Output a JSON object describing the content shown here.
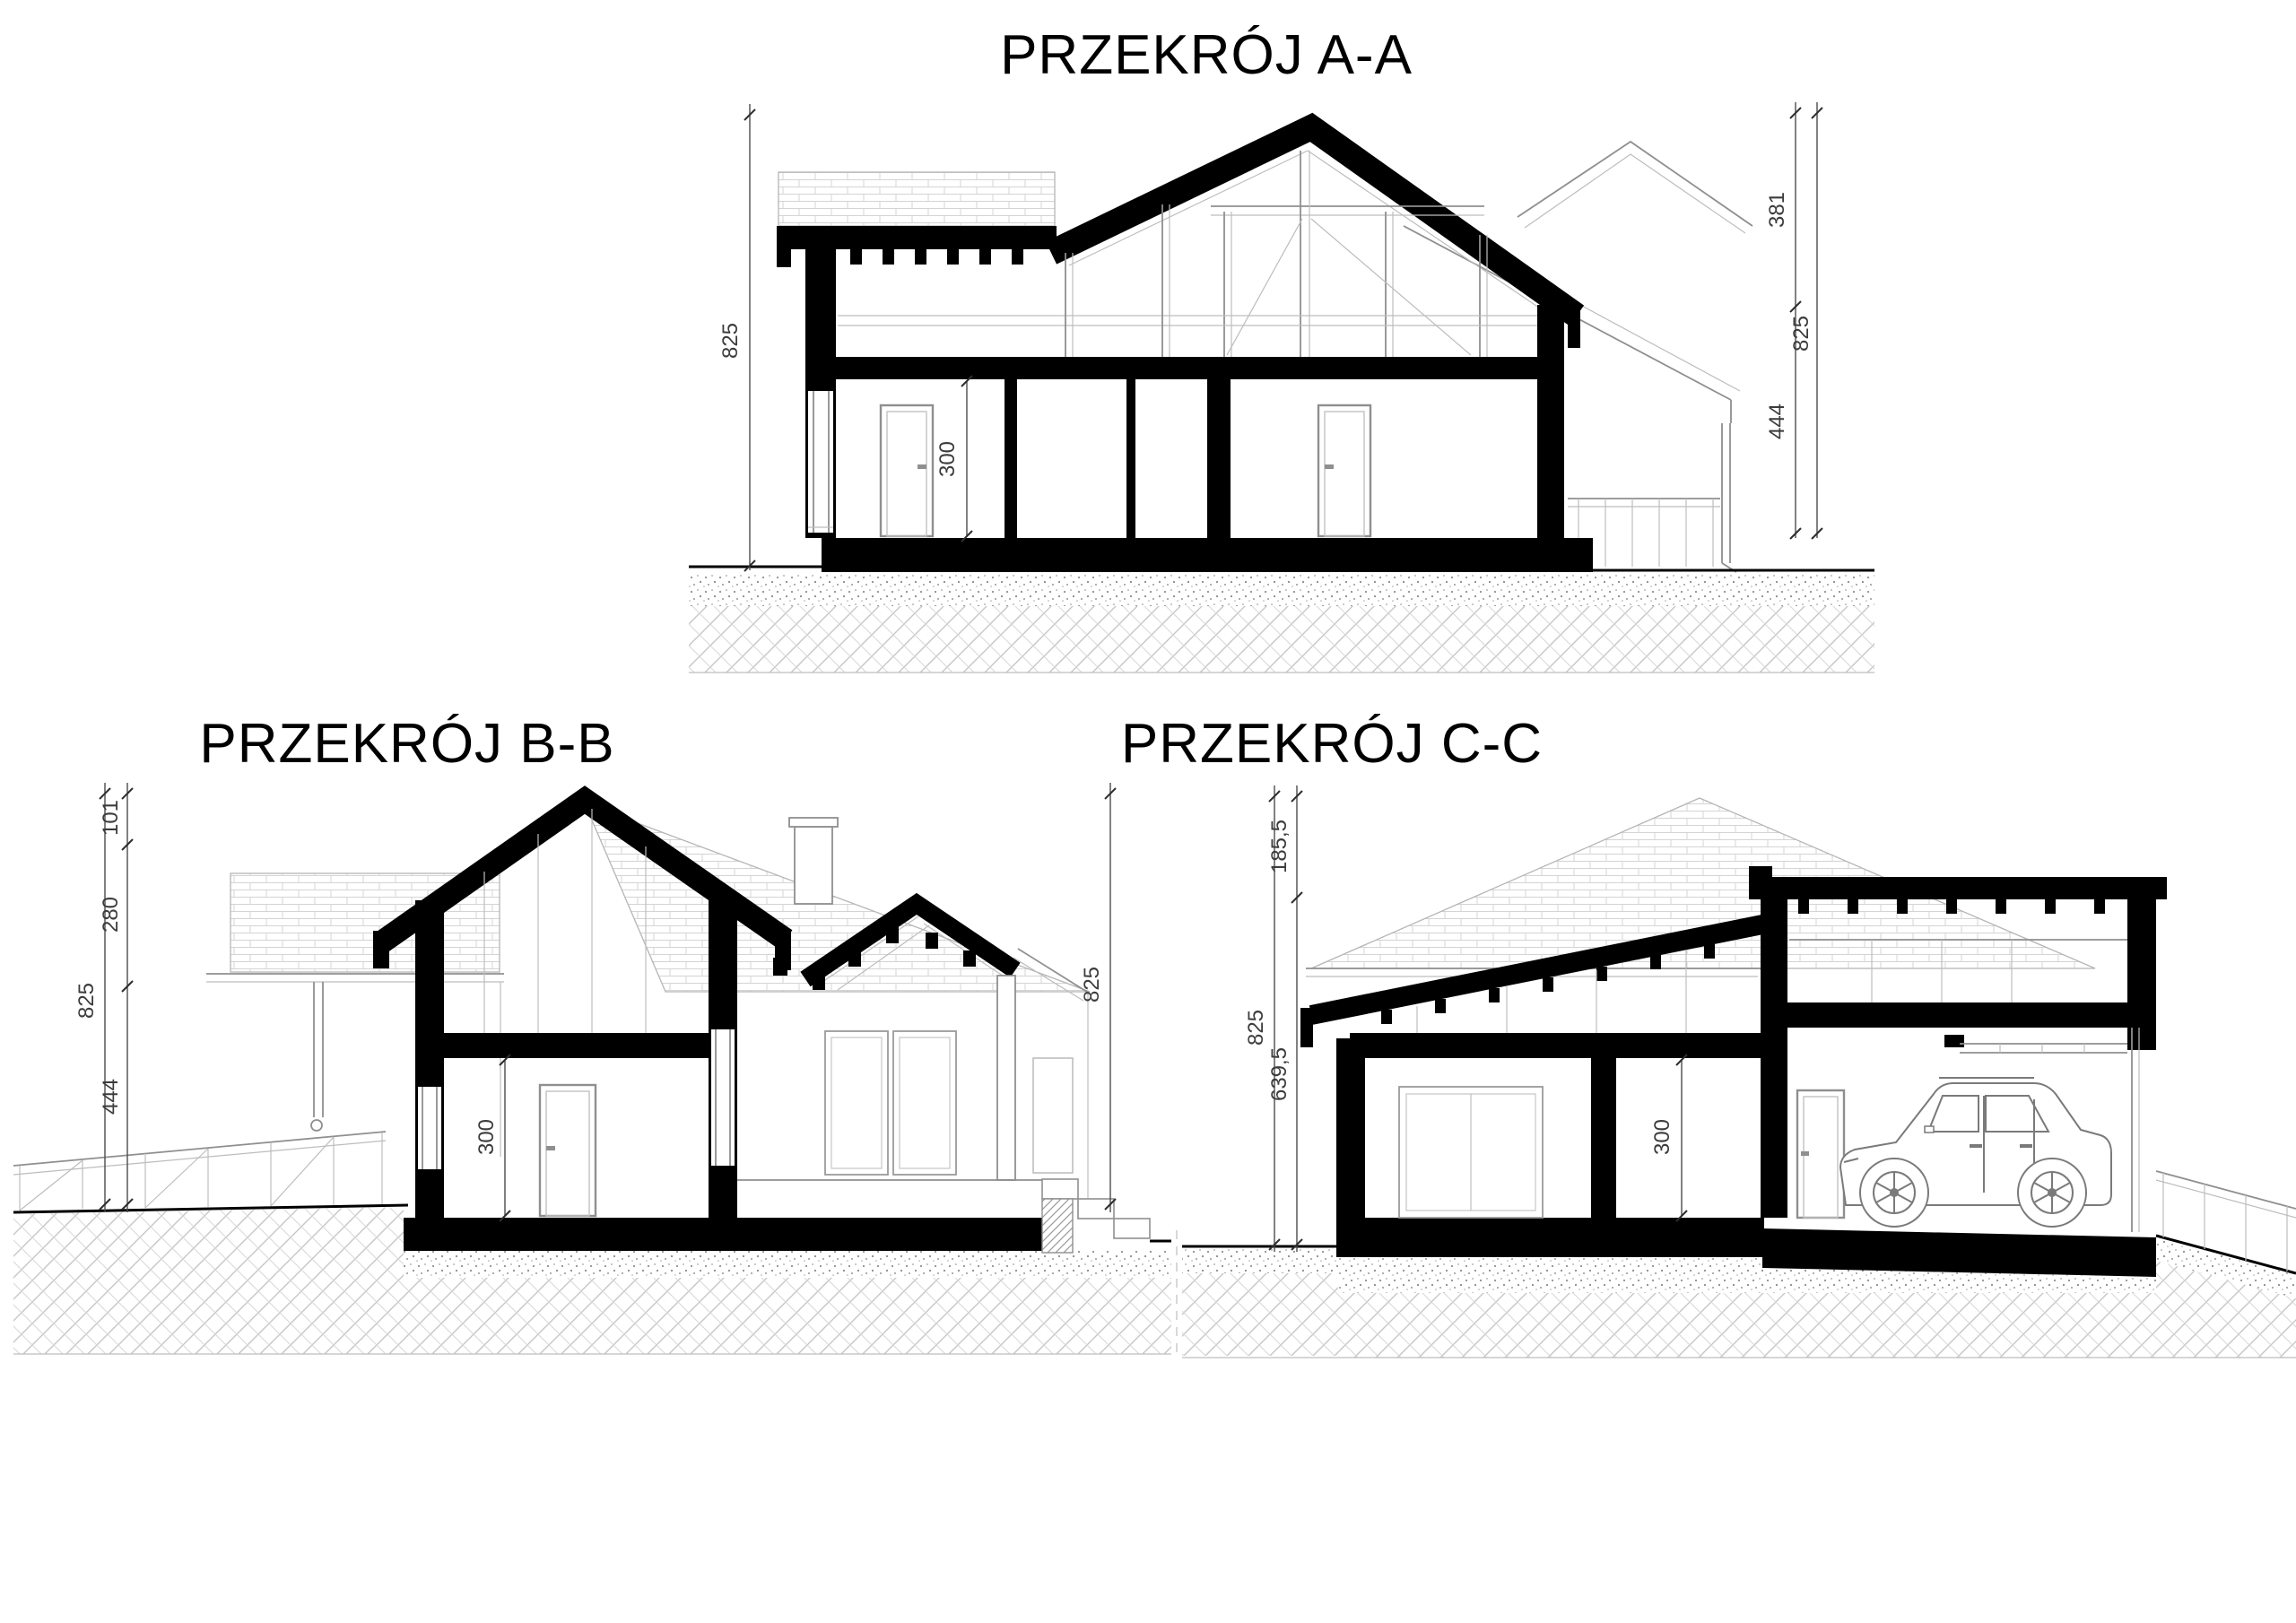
{
  "drawing": {
    "background": "#ffffff",
    "type": "architectural-cross-sections",
    "sections": [
      {
        "id": "A",
        "title": "PRZEKRÓJ A-A",
        "dims": {
          "left_total": "825",
          "interior_height": "300",
          "right_upper": "381",
          "right_lower": "444",
          "right_total": "825"
        }
      },
      {
        "id": "B",
        "title": "PRZEKRÓJ B-B",
        "dims": {
          "left_total": "825",
          "left_top": "101",
          "left_mid": "280",
          "left_bottom": "444",
          "interior_height": "300",
          "right_total": "825"
        }
      },
      {
        "id": "C",
        "title": "PRZEKRÓJ C-C",
        "dims": {
          "left_total": "825",
          "left_top": "185,5",
          "left_bottom": "639,5",
          "interior_height": "300"
        }
      }
    ],
    "colors": {
      "cut_fill": "#000000",
      "elevation_line": "#8f8f8f",
      "dimension_line": "#4c4c4c",
      "ground_line": "#000000"
    }
  }
}
